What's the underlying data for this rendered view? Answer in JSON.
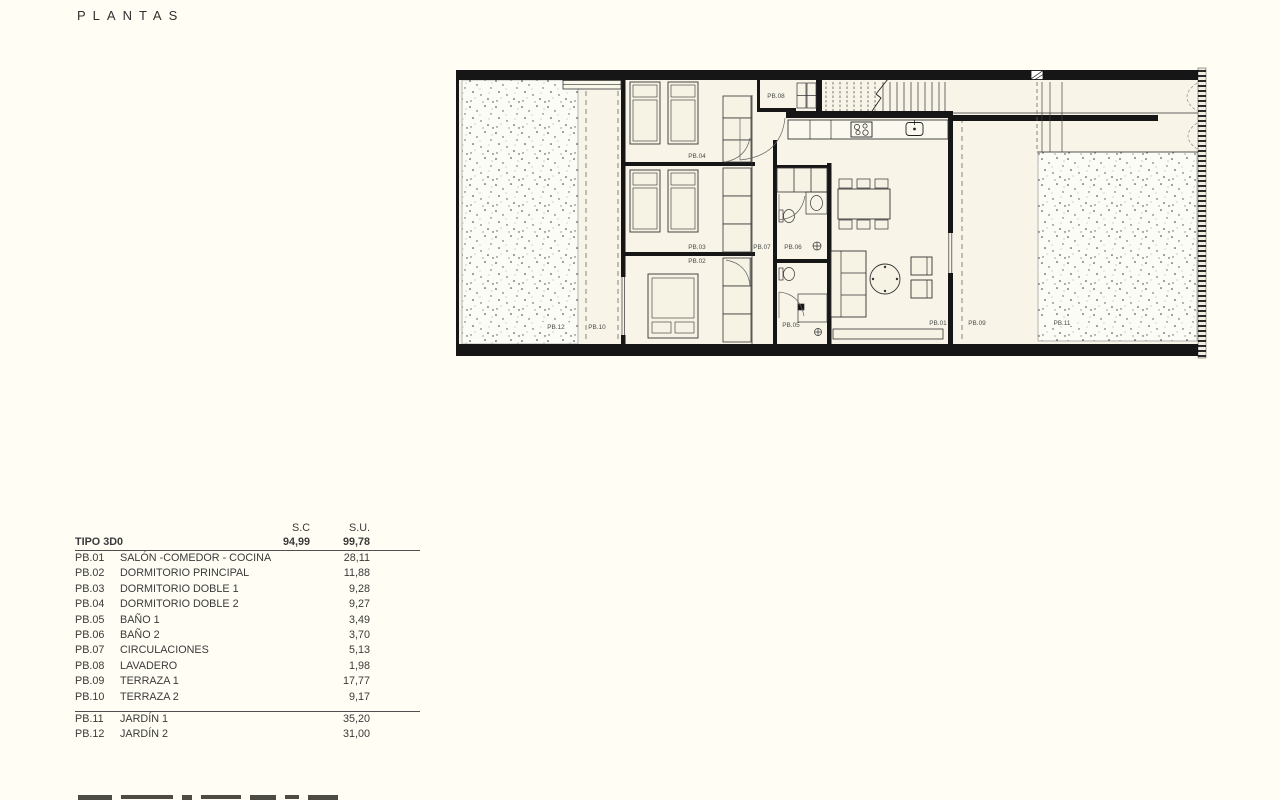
{
  "title": "PLANTAS",
  "plan": {
    "room_labels": {
      "pb01": "PB.01",
      "pb02": "PB.02",
      "pb03": "PB.03",
      "pb04": "PB.04",
      "pb05": "PB.05",
      "pb06": "PB.06",
      "pb07": "PB.07",
      "pb08": "PB.08",
      "pb09": "PB.09",
      "pb10": "PB.10",
      "pb11": "PB.11",
      "pb12": "PB.12"
    }
  },
  "legend": {
    "headers": {
      "sc": "S.C",
      "su": "S.U."
    },
    "type_row": {
      "name": "TIPO 3D0",
      "sc": "94,99",
      "su": "99,78"
    },
    "rows": [
      {
        "code": "PB.01",
        "name": "SALÓN -COMEDOR - COCINA",
        "su": "28,11"
      },
      {
        "code": "PB.02",
        "name": "DORMITORIO PRINCIPAL",
        "su": "11,88"
      },
      {
        "code": "PB.03",
        "name": "DORMITORIO DOBLE 1",
        "su": "9,28"
      },
      {
        "code": "PB.04",
        "name": "DORMITORIO DOBLE 2",
        "su": "9,27"
      },
      {
        "code": "PB.05",
        "name": "BAÑO 1",
        "su": "3,49"
      },
      {
        "code": "PB.06",
        "name": "BAÑO 2",
        "su": "3,70"
      },
      {
        "code": "PB.07",
        "name": "CIRCULACIONES",
        "su": "5,13"
      },
      {
        "code": "PB.08",
        "name": "LAVADERO",
        "su": "1,98"
      },
      {
        "code": "PB.09",
        "name": "TERRAZA 1",
        "su": "17,77"
      },
      {
        "code": "PB.10",
        "name": "TERRAZA 2",
        "su": "9,17"
      }
    ],
    "rows_outdoor": [
      {
        "code": "PB.11",
        "name": "JARDÍN 1",
        "su": "35,20"
      },
      {
        "code": "PB.12",
        "name": "JARDÍN 2",
        "su": "31,00"
      }
    ]
  },
  "colors": {
    "background": "#fffdf4",
    "ink": "#161616",
    "room_fill": "#f8f5e8"
  }
}
